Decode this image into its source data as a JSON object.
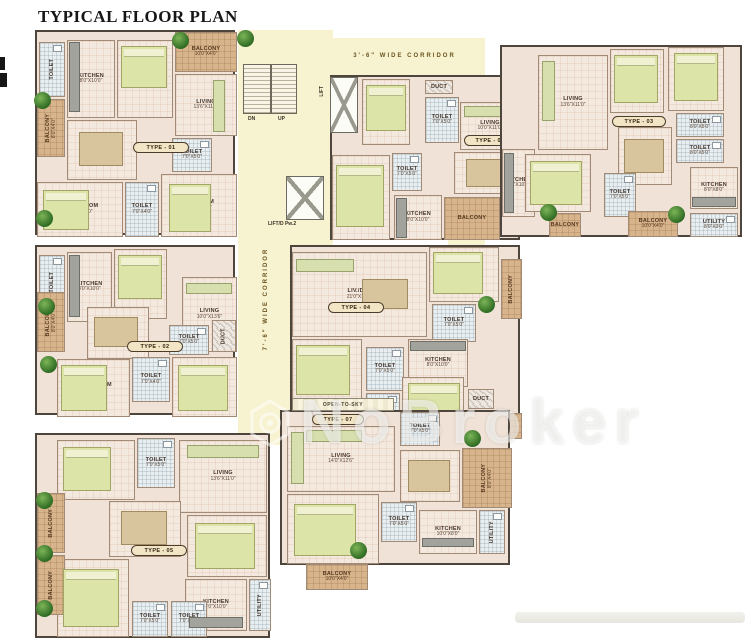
{
  "title": "TYPICAL FLOOR PLAN",
  "watermark": {
    "brand": "NoBroker"
  },
  "corridors": {
    "top": "3'-6\" WIDE CORRIDOR",
    "main": "7'-6\" WIDE CORRIDOR"
  },
  "common": {
    "stair_dn": "DN",
    "stair_up": "UP",
    "lift": "LIFT",
    "lift2": "LIFT/D Pw.2",
    "open_to_sky": "OPEN-TO-SKY"
  },
  "units": [
    {
      "type_label": "TYPE - 01",
      "rooms": [
        {
          "name": "KITCHEN",
          "dims": "8'0\"X10'0\""
        },
        {
          "name": "TOILET",
          "dims": ""
        },
        {
          "name": "BEDROOM",
          "dims": "10'0\"X11'6\""
        },
        {
          "name": "BALCONY",
          "dims": "10'0\"X4'0\""
        },
        {
          "name": "LIVING",
          "dims": "13'6\"X11'0\""
        },
        {
          "name": "DINING",
          "dims": "10'0\"X10'6\""
        },
        {
          "name": "BALCONY",
          "dims": "8'0\"X4'0\""
        },
        {
          "name": "TOILET",
          "dims": "7'0\"X5'0\""
        },
        {
          "name": "M.BEDROOM",
          "dims": "12'0\"X11'0\""
        },
        {
          "name": "TOILET",
          "dims": "7'0\"X4'0\""
        },
        {
          "name": "BEDROOM",
          "dims": "10'0\"X11'0\""
        }
      ]
    },
    {
      "type_label": "TYPE - 06",
      "rooms": [
        {
          "name": "BEDROOM",
          "dims": "10'0\"X11'6\""
        },
        {
          "name": "DUCT",
          "dims": ""
        },
        {
          "name": "TOILET",
          "dims": "7'0\"X5'0\""
        },
        {
          "name": "LIVING",
          "dims": "10'0\"X11'0\""
        },
        {
          "name": "M.BEDROOM",
          "dims": "11'0\"X12'0\""
        },
        {
          "name": "TOILET",
          "dims": "7'0\"X5'0\""
        },
        {
          "name": "DINING",
          "dims": "10'0\"X10'6\""
        },
        {
          "name": "KITCHEN",
          "dims": "8'0\"X10'0\""
        },
        {
          "name": "BALCONY",
          "dims": ""
        }
      ]
    },
    {
      "type_label": "TYPE - 03",
      "rooms": [
        {
          "name": "KITCHEN",
          "dims": "8'0\"X10'0\""
        },
        {
          "name": "LIVING",
          "dims": "13'6\"X11'0\""
        },
        {
          "name": "BEDROOM",
          "dims": "10'0\"X11'6\""
        },
        {
          "name": "BEDROOM",
          "dims": "10'0\"X11'0\""
        },
        {
          "name": "TOILET",
          "dims": "8'0\"X5'0\""
        },
        {
          "name": "TOILET",
          "dims": "8'0\"X5'0\""
        },
        {
          "name": "DINING",
          "dims": "10'0\"X12'0\""
        },
        {
          "name": "M.BEDROOM",
          "dims": "11'0\"X12'0\""
        },
        {
          "name": "TOILET",
          "dims": "7'0\"X5'0\""
        },
        {
          "name": "KITCHEN",
          "dims": "8'0\"X8'0\""
        },
        {
          "name": "BALCONY",
          "dims": ""
        },
        {
          "name": "BALCONY",
          "dims": "10'0\"X4'0\""
        },
        {
          "name": "UTILITY",
          "dims": "8'0\"X3'0\""
        }
      ]
    },
    {
      "type_label": "TYPE - 02",
      "rooms": [
        {
          "name": "TOILET",
          "dims": ""
        },
        {
          "name": "KITCHEN",
          "dims": "8'0\"X10'0\""
        },
        {
          "name": "BEDROOM",
          "dims": "10'0\"X11'6\""
        },
        {
          "name": "LIVING",
          "dims": "10'0\"X13'6\""
        },
        {
          "name": "BALCONY",
          "dims": "8'0\"X4'0\""
        },
        {
          "name": "DINING",
          "dims": "10'0\"X10'6\""
        },
        {
          "name": "TOILET",
          "dims": "7'0\"X5'0\""
        },
        {
          "name": "DUCT",
          "dims": ""
        },
        {
          "name": "M.BEDROOM",
          "dims": "12'0\"X11'0\""
        },
        {
          "name": "TOILET",
          "dims": "7'0\"X4'0\""
        },
        {
          "name": "BEDROOM",
          "dims": "10'0\"X11'0\""
        }
      ]
    },
    {
      "type_label": "TYPE - 04",
      "rooms": [
        {
          "name": "LIV./DIN.",
          "dims": "21'0\"X12'0\""
        },
        {
          "name": "BEDROOM",
          "dims": "10'0\"X11'6\""
        },
        {
          "name": "BALCONY",
          "dims": ""
        },
        {
          "name": "TOILET",
          "dims": "7'0\"X5'0\""
        },
        {
          "name": "M.BEDROOM",
          "dims": "11'0\"X12'0\""
        },
        {
          "name": "TOILET",
          "dims": "7'0\"X5'0\""
        },
        {
          "name": "KITCHEN",
          "dims": "8'0\"X10'0\""
        },
        {
          "name": "BEDROOM",
          "dims": "10'0\"X11'6\""
        },
        {
          "name": "TOILET",
          "dims": "7'0\"X5'0\""
        },
        {
          "name": "DUCT",
          "dims": ""
        },
        {
          "name": "BALCONY",
          "dims": ""
        }
      ]
    },
    {
      "type_label": "TYPE - 05",
      "rooms": [
        {
          "name": "BEDROOM",
          "dims": "10'0\"X11'6\""
        },
        {
          "name": "TOILET",
          "dims": "7'0\"X5'0\""
        },
        {
          "name": "LIVING",
          "dims": "13'6\"X11'0\""
        },
        {
          "name": "DINING",
          "dims": "10'0\"X10'0\""
        },
        {
          "name": "BALCONY",
          "dims": ""
        },
        {
          "name": "BEDROOM",
          "dims": "10'0\"X11'0\""
        },
        {
          "name": "KITCHEN",
          "dims": "8'0\"X10'0\""
        },
        {
          "name": "UTILITY",
          "dims": ""
        },
        {
          "name": "M.BEDROOM",
          "dims": "12'0\"X11'0\""
        },
        {
          "name": "TOILET",
          "dims": "7'0\"X5'0\""
        },
        {
          "name": "TOILET",
          "dims": "7'0\"X5'0\""
        },
        {
          "name": "BALCONY",
          "dims": ""
        }
      ]
    },
    {
      "type_label": "TYPE - 07",
      "rooms": [
        {
          "name": "LIVING",
          "dims": "14'0\"X12'6\""
        },
        {
          "name": "TOILET",
          "dims": "7'0\"X5'0\""
        },
        {
          "name": "DINING",
          "dims": "10'0\"X12'0\""
        },
        {
          "name": "BALCONY",
          "dims": "8'0\"X4'0\""
        },
        {
          "name": "M.BEDROOM",
          "dims": "11'0\"X12'0\""
        },
        {
          "name": "TOILET",
          "dims": "7'0\"X5'0\""
        },
        {
          "name": "KITCHEN",
          "dims": "10'0\"X8'0\""
        },
        {
          "name": "UTILITY",
          "dims": ""
        },
        {
          "name": "BALCONY",
          "dims": "10'0\"X4'0\""
        }
      ]
    }
  ]
}
